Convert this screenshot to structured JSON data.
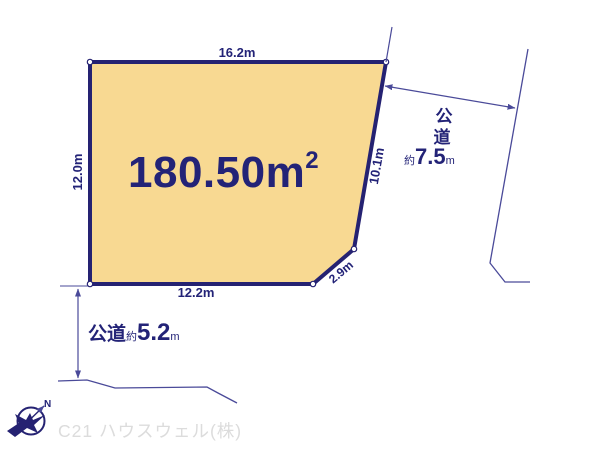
{
  "colors": {
    "parcel_fill": "#F8D992",
    "parcel_border": "#252272",
    "dimension_text": "#232377",
    "thin_line": "#4A4A99",
    "watermark_gray": "#DCDCDC"
  },
  "parcel": {
    "area_main": "180.50m",
    "area_sup": "2",
    "dim_top": "16.2m",
    "dim_left": "12.0m",
    "dim_right": "10.1m",
    "dim_bottom": "12.2m",
    "dim_corner": "2.9m"
  },
  "road_east": {
    "label_char_1": "公",
    "label_char_2": "道",
    "approx_prefix": "約",
    "width_value": "7.5",
    "width_unit": "m"
  },
  "road_south": {
    "label": "公道",
    "approx_prefix": "約",
    "width_value": "5.2",
    "width_unit": "m"
  },
  "compass": {
    "north_label": "N"
  },
  "footer": {
    "company_watermark": "C21 ハウスウェル(株)"
  }
}
